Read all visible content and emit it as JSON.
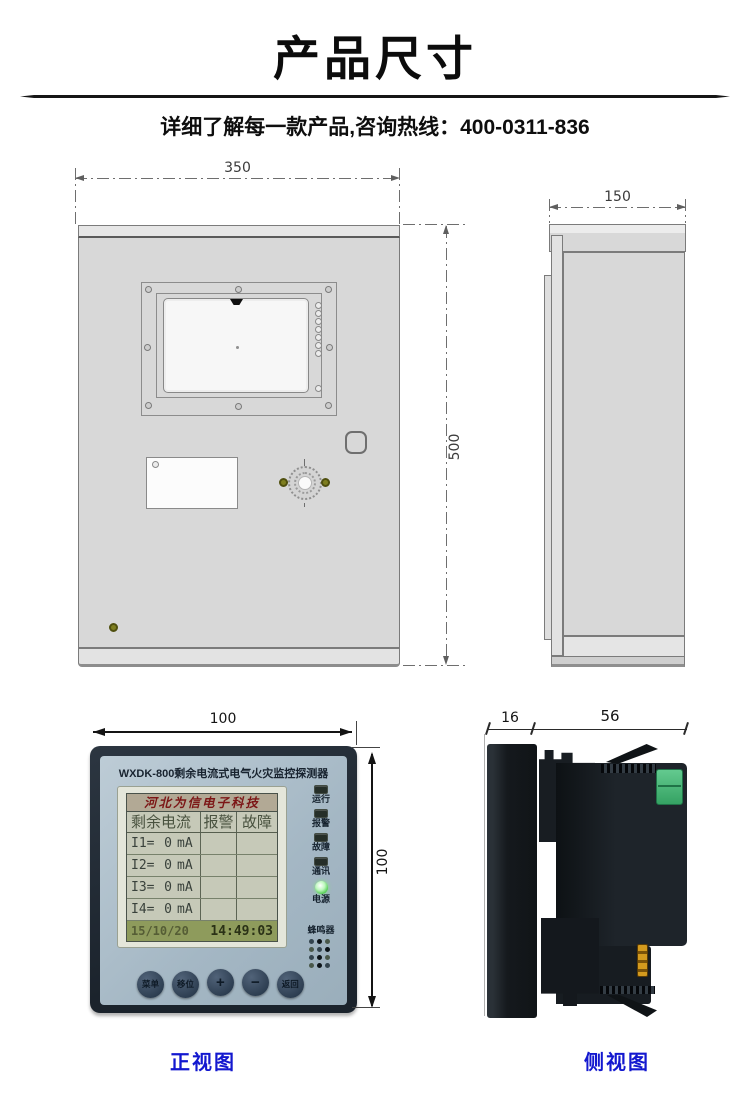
{
  "page": {
    "title": "产品尺寸",
    "subtitle": "详细了解每一款产品,咨询热线：400-0311-836"
  },
  "cabinet_front_view": {
    "width_mm": "350",
    "height_mm": "500"
  },
  "cabinet_side_view": {
    "depth_mm": "150"
  },
  "detector_front_view": {
    "width_mm": "100",
    "height_mm": "100",
    "title": "WXDK-800剩余电流式电气火灾监控探测器",
    "lcd": {
      "brand": "河北为信电子科技",
      "columns": [
        "剩余电流",
        "报警",
        "故障"
      ],
      "rows": [
        {
          "channel": "I1=",
          "value": "0",
          "unit": "mA"
        },
        {
          "channel": "I2=",
          "value": "0",
          "unit": "mA"
        },
        {
          "channel": "I3=",
          "value": "0",
          "unit": "mA"
        },
        {
          "channel": "I4=",
          "value": "0",
          "unit": "mA"
        }
      ],
      "date": "15/10/20",
      "time": "14:49:03"
    },
    "indicators": [
      {
        "label": "运行",
        "lit": false
      },
      {
        "label": "报警",
        "lit": false
      },
      {
        "label": "故障",
        "lit": false
      },
      {
        "label": "通讯",
        "lit": false
      },
      {
        "label": "电源",
        "lit": true
      }
    ],
    "buzzer_label": "蜂鸣器",
    "buttons": [
      "菜单",
      "移位",
      "+",
      "−",
      "返回"
    ],
    "caption": "正视图"
  },
  "detector_side_view": {
    "front_depth_mm": "16",
    "body_depth_mm": "56",
    "caption": "侧视图"
  },
  "colors": {
    "caption_blue": "#1318cf",
    "panel_face": "#a9bbc7",
    "bezel_dark": "#222b35",
    "lcd_bg": "#c6c9b8",
    "lcd_status_bg": "#8e9b5c",
    "brand_red": "#7c1616",
    "led_green": "#4ecb4e",
    "terminal_green": "#3aa56a",
    "drawing_gray": "#d8d8d8"
  }
}
